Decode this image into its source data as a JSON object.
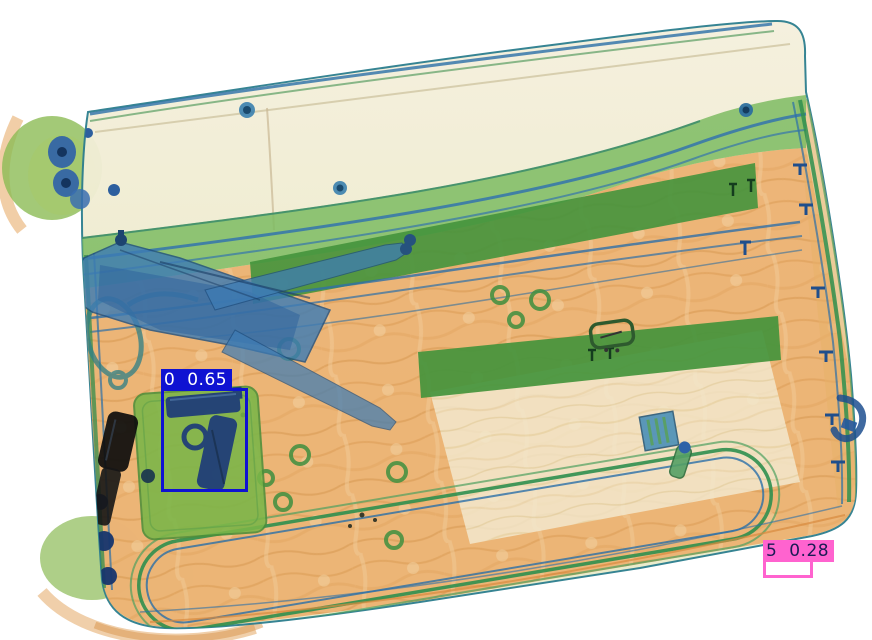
{
  "scene": {
    "type": "x-ray baggage scan of a suitcase with detection overlays",
    "background_color": "#ffffff",
    "visible_objects": [
      "suitcase-shell",
      "handgun",
      "crossbow-like-blue-tool",
      "flashlight",
      "green-strap-band",
      "telescopic-handle-bars",
      "wheel-clusters",
      "piping-frame-lines",
      "grommet-rings",
      "buckle",
      "small-box-item",
      "small-cylinder-item",
      "small-object-bottom-right",
      "side-handle"
    ]
  },
  "palette": {
    "fabric_orange": "#eaa860",
    "strap_green": "#7cbb62",
    "bar_green": "#44943c",
    "dense_blue": "#3e7cb4",
    "shell_cream": "#f3eedb",
    "detection_blue": "#0f12d2",
    "detection_pink": "#ff63cf"
  },
  "detections": [
    {
      "class_id": "0",
      "confidence": "0.65",
      "label": "0 0.65",
      "color": "#0f12d2",
      "text_color": "#ffffff",
      "box": {
        "x": 161,
        "y": 388,
        "w": 87,
        "h": 104
      }
    },
    {
      "class_id": "5",
      "confidence": "0.28",
      "label": "5 0.28",
      "color": "#ff63cf",
      "text_color": "#1b1b55",
      "box": {
        "x": 763,
        "y": 559,
        "w": 50,
        "h": 19
      }
    }
  ]
}
